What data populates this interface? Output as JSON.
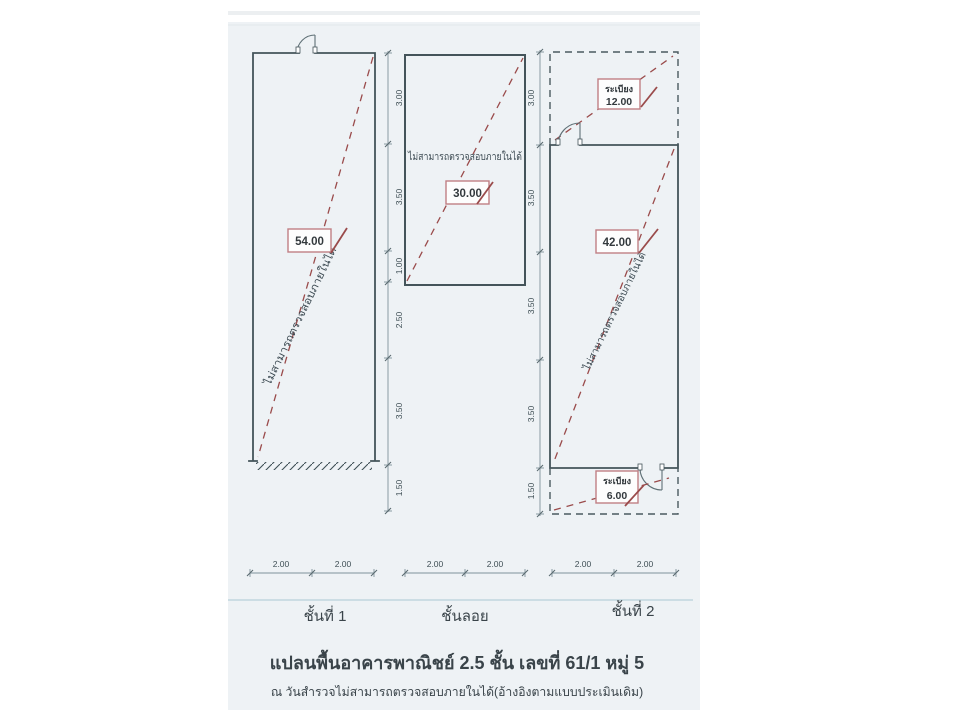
{
  "document": {
    "title": "แปลนพื้นอาคารพาณิชย์ 2.5 ชั้น เลขที่ 61/1 หมู่ 5",
    "subtitle": "ณ วันสำรวจไม่สามารถตรวจสอบภายในได้(อ้างอิงตามแบบประเมินเดิม)"
  },
  "floors": [
    {
      "name": "ชั้นที่ 1",
      "area": "54.00",
      "note": "ไม่สามารถตรวจสอบภายในได้",
      "v_dims": [
        "3.00",
        "3.50",
        "1.00",
        "2.50",
        "3.50",
        "1.50"
      ],
      "h_dims": [
        "2.00",
        "2.00"
      ]
    },
    {
      "name": "ชั้นลอย",
      "area": "30.00",
      "note": "ไม่สามารถตรวจสอบภายในได้",
      "h_dims": [
        "2.00",
        "2.00"
      ]
    },
    {
      "name": "ชั้นที่ 2",
      "area": "42.00",
      "note": "ไม่สามารถตรวจสอบภายในได้",
      "v_dims": [
        "3.00",
        "3.50",
        "3.50",
        "3.50",
        "1.50"
      ],
      "h_dims": [
        "2.00",
        "2.00"
      ],
      "balconies": [
        {
          "label": "ระเบียง",
          "area": "12.00"
        },
        {
          "label": "ระเบียง",
          "area": "6.00"
        }
      ]
    }
  ],
  "colors": {
    "wall": "#44545a",
    "dimension": "#7f929a",
    "annotation_red": "#9a4b4b",
    "label_box_border": "#c07f84",
    "footer_rule": "#abc8d2",
    "scan_background": "#eef2f5"
  }
}
